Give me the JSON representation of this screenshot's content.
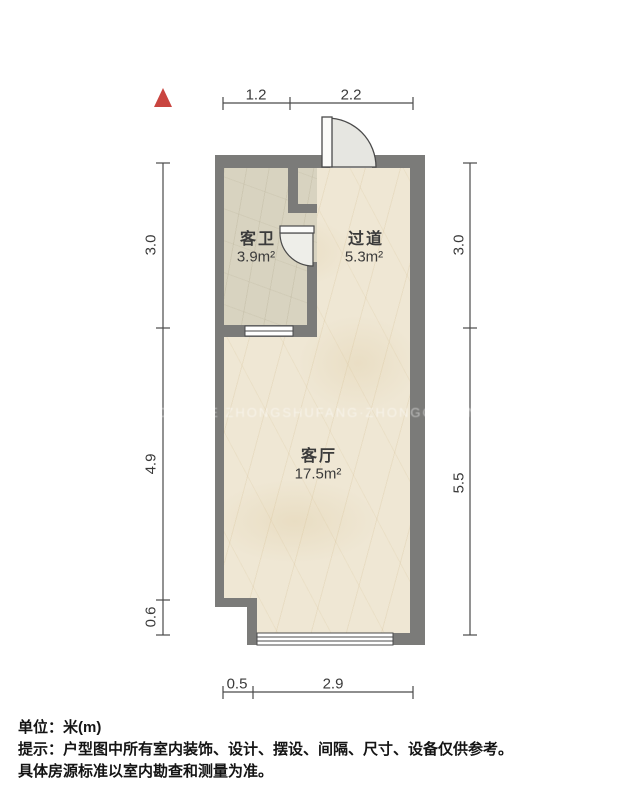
{
  "plan": {
    "rooms": [
      {
        "name": "客卫",
        "area": "3.9m²"
      },
      {
        "name": "过道",
        "area": "5.3m²"
      },
      {
        "name": "客厅",
        "area": "17.5m²"
      }
    ],
    "dimensions": {
      "top": [
        "1.2",
        "2.2"
      ],
      "bottom": [
        "0.5",
        "2.9"
      ],
      "left": [
        "3.0",
        "4.9",
        "0.6"
      ],
      "right": [
        "3.0",
        "5.5"
      ]
    }
  },
  "watermark": "HOWLIVE ZHONGSHUFANG·ZHONGCHUANG JL",
  "footer": {
    "unit": "单位：米(m)",
    "tip": "提示：户型图中所有室内装饰、设计、摆设、间隔、尺寸、设备仅供参考。",
    "tip2": "具体房源标准以室内勘查和测量为准。"
  },
  "colors": {
    "wall": "#7b7b79",
    "floor_main": "#efe7d4",
    "floor_bath": "#d8d3c0",
    "north_arrow": "#c94540",
    "line": "#4a4a4a"
  }
}
